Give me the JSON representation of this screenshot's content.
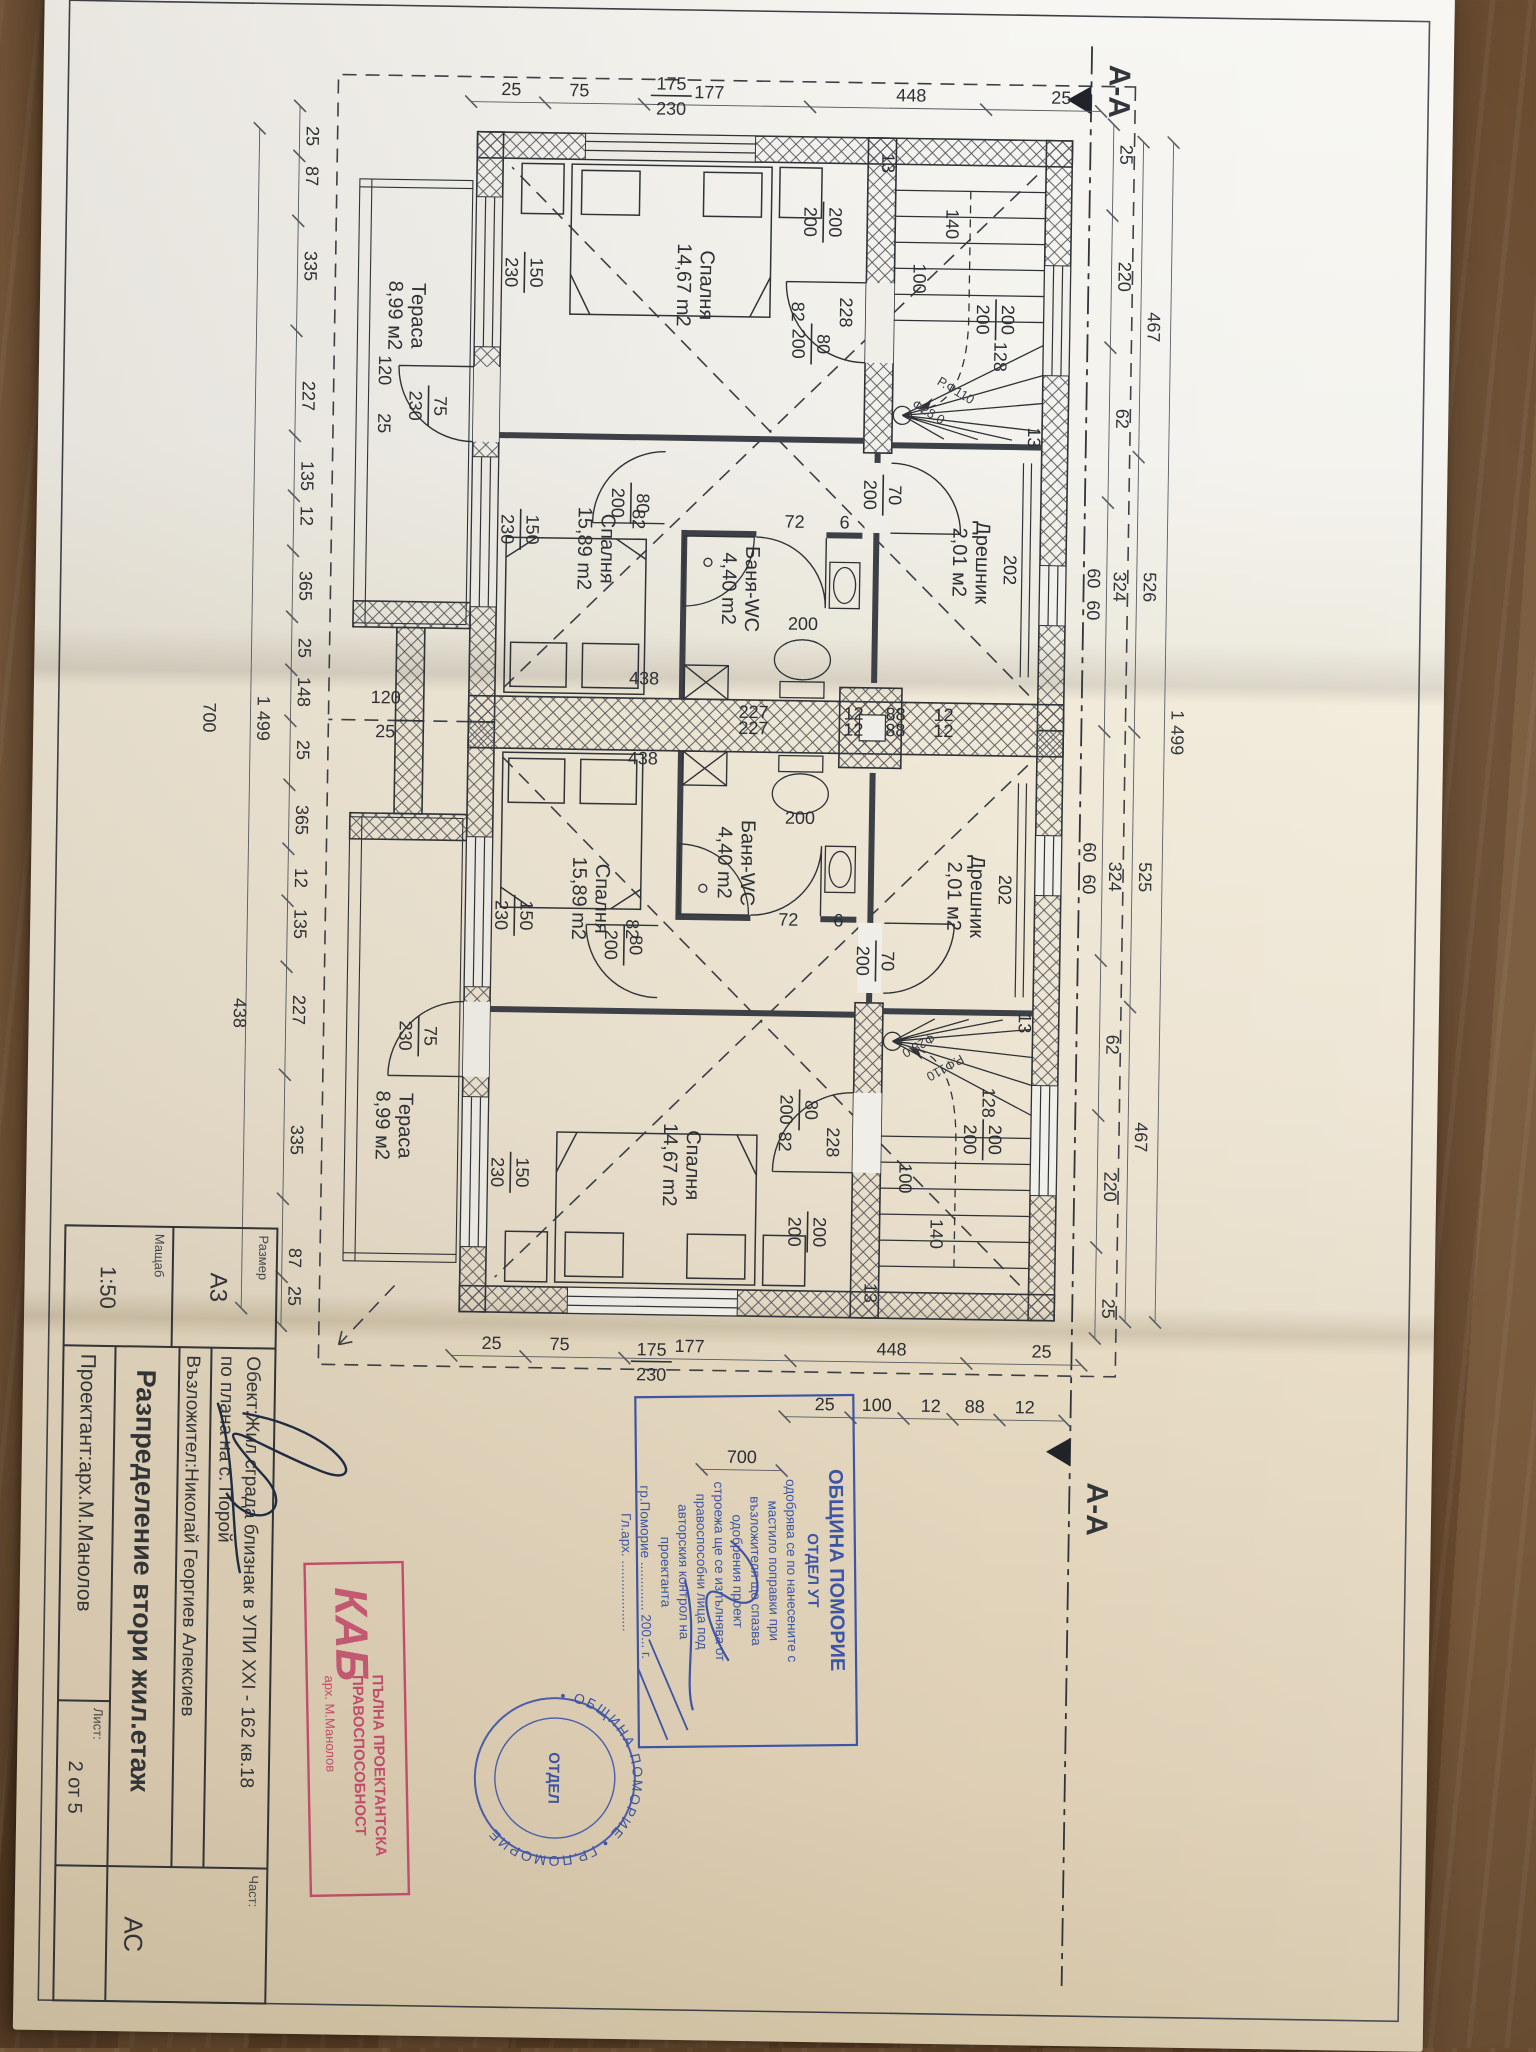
{
  "title_block": {
    "size_label": "Размер",
    "size": "А3",
    "scale_label": "Мащаб",
    "scale": "1:50",
    "object_line1": "Обект:Жил.сграда близнак в УПИ XXI - 162 кв.18",
    "object_line2": "по плана на с. Порой",
    "client": "Възложител:Николай Георгиев Алексиев",
    "drawing_title": "Разпределение втори жил.етаж",
    "designer": "Проектант:арх.М.Манолов",
    "sheet_label": "Лист:",
    "sheet": "2 от 5",
    "part_label": "Част:",
    "part": "АС"
  },
  "section": {
    "label": "А-А"
  },
  "stamps": {
    "municipality": {
      "lines": [
        "ОБЩИНА ПОМОРИЕ",
        "ОТДЕЛ УТ",
        "одобрява се по нанесените с",
        "мастило поправки при",
        "възложителя ще спазва",
        "одобрения проект",
        "строежа ще се изпълнява от",
        "правоспособни лица под",
        "авторския контрол на",
        "проектанта",
        "гр.Поморие ............. 200... г.",
        "Гл.арх. ..................."
      ]
    },
    "seal": {
      "rim": "• ОБЩИНА ПОМОРИЕ • ГР.ПОМОРИЕ",
      "center": "ОТДЕЛ"
    },
    "license": {
      "logo": "КАБ",
      "line1": "ПЪЛНА ПРОЕКТАНТСКА",
      "line2": "ПРАВОСПОСОБНОСТ",
      "name": "арх. М.Манолов"
    }
  },
  "plan": {
    "rooms": [
      {
        "lines": [
          "Спалня",
          "14,67 m2"
        ],
        "x": 305,
        "y": 750
      },
      {
        "lines": [
          "Спалня",
          "15,89 m2"
        ],
        "x": 570,
        "y": 845
      },
      {
        "lines": [
          "Баня-WC",
          "4,40 m2"
        ],
        "x": 608,
        "y": 700
      },
      {
        "lines": [
          "Дрешник",
          "2,01 м2"
        ],
        "x": 578,
        "y": 470
      },
      {
        "lines": [
          "Тераса",
          "8,99 м2"
        ],
        "x": 340,
        "y": 1038
      },
      {
        "lines": [
          "Спалня",
          "14,67 m2"
        ],
        "x": 1185,
        "y": 750
      },
      {
        "lines": [
          "Спалня",
          "15,89 m2"
        ],
        "x": 920,
        "y": 845
      },
      {
        "lines": [
          "Баня-WC",
          "4,40 m2"
        ],
        "x": 882,
        "y": 700
      },
      {
        "lines": [
          "Дрешник",
          "2,01 м2"
        ],
        "x": 912,
        "y": 470
      },
      {
        "lines": [
          "Тераса",
          "8,99 м2"
        ],
        "x": 1150,
        "y": 1038
      }
    ],
    "tags": [
      {
        "a": "175",
        "b": "230",
        "x": 112,
        "y": 782,
        "r": -90
      },
      {
        "a": "200",
        "b": "200",
        "x": 335,
        "y": 450
      },
      {
        "a": "200",
        "b": "200",
        "x": 240,
        "y": 624
      },
      {
        "a": "150",
        "b": "230",
        "x": 295,
        "y": 922
      },
      {
        "a": "150",
        "b": "230",
        "x": 552,
        "y": 922
      },
      {
        "a": "75",
        "b": "230",
        "x": 430,
        "y": 1016
      },
      {
        "a": "80",
        "b": "200",
        "x": 362,
        "y": 634
      },
      {
        "a": "80",
        "b": "200",
        "x": 524,
        "y": 812
      },
      {
        "a": "70",
        "b": "200",
        "x": 512,
        "y": 560
      },
      {
        "a": "175",
        "b": "230",
        "x": 1378,
        "y": 782,
        "r": -90
      },
      {
        "a": "200",
        "b": "200",
        "x": 1155,
        "y": 450
      },
      {
        "a": "200",
        "b": "200",
        "x": 1250,
        "y": 624
      },
      {
        "a": "150",
        "b": "230",
        "x": 1195,
        "y": 922
      },
      {
        "a": "150",
        "b": "230",
        "x": 938,
        "y": 922
      },
      {
        "a": "75",
        "b": "230",
        "x": 1060,
        "y": 1016
      },
      {
        "a": "80",
        "b": "200",
        "x": 1128,
        "y": 634
      },
      {
        "a": "80",
        "b": "200",
        "x": 966,
        "y": 812
      },
      {
        "a": "70",
        "b": "200",
        "x": 978,
        "y": 560
      }
    ],
    "dims": [
      {
        "t": "25",
        "x": 168,
        "y": 332
      },
      {
        "t": "220",
        "x": 290,
        "y": 332
      },
      {
        "t": "62",
        "x": 432,
        "y": 332
      },
      {
        "t": "324",
        "x": 600,
        "y": 332
      },
      {
        "t": "324",
        "x": 890,
        "y": 332
      },
      {
        "t": "62",
        "x": 1058,
        "y": 332
      },
      {
        "t": "220",
        "x": 1200,
        "y": 332
      },
      {
        "t": "25",
        "x": 1322,
        "y": 332
      },
      {
        "t": "467",
        "x": 340,
        "y": 302
      },
      {
        "t": "526",
        "x": 600,
        "y": 302
      },
      {
        "t": "525",
        "x": 890,
        "y": 302
      },
      {
        "t": "467",
        "x": 1150,
        "y": 302
      },
      {
        "t": "1 499",
        "x": 745,
        "y": 272
      },
      {
        "t": "25",
        "x": 162,
        "y": 1146
      },
      {
        "t": "87",
        "x": 202,
        "y": 1146
      },
      {
        "t": "335",
        "x": 292,
        "y": 1146
      },
      {
        "t": "227",
        "x": 422,
        "y": 1146
      },
      {
        "t": "135",
        "x": 502,
        "y": 1146
      },
      {
        "t": "12",
        "x": 542,
        "y": 1146
      },
      {
        "t": "365",
        "x": 612,
        "y": 1146
      },
      {
        "t": "25",
        "x": 674,
        "y": 1146
      },
      {
        "t": "148",
        "x": 718,
        "y": 1146
      },
      {
        "t": "25",
        "x": 776,
        "y": 1146
      },
      {
        "t": "365",
        "x": 846,
        "y": 1146
      },
      {
        "t": "12",
        "x": 904,
        "y": 1146
      },
      {
        "t": "135",
        "x": 950,
        "y": 1146
      },
      {
        "t": "227",
        "x": 1036,
        "y": 1146
      },
      {
        "t": "335",
        "x": 1166,
        "y": 1146
      },
      {
        "t": "87",
        "x": 1284,
        "y": 1146
      },
      {
        "t": "25",
        "x": 1322,
        "y": 1146
      },
      {
        "t": "1 499",
        "x": 745,
        "y": 1186
      },
      {
        "t": "25",
        "x": 118,
        "y": 392,
        "r": -90
      },
      {
        "t": "448",
        "x": 118,
        "y": 542,
        "r": -90
      },
      {
        "t": "177",
        "x": 118,
        "y": 744,
        "r": -90
      },
      {
        "t": "75",
        "x": 118,
        "y": 874,
        "r": -90
      },
      {
        "t": "25",
        "x": 118,
        "y": 942,
        "r": -90
      },
      {
        "t": "25",
        "x": 1372,
        "y": 392,
        "r": -90
      },
      {
        "t": "448",
        "x": 1372,
        "y": 542,
        "r": -90
      },
      {
        "t": "177",
        "x": 1372,
        "y": 744,
        "r": -90
      },
      {
        "t": "75",
        "x": 1372,
        "y": 874,
        "r": -90
      },
      {
        "t": "25",
        "x": 1372,
        "y": 942,
        "r": -90
      },
      {
        "t": "12",
        "x": 1428,
        "y": 408,
        "r": -90
      },
      {
        "t": "88",
        "x": 1428,
        "y": 458,
        "r": -90
      },
      {
        "t": "12",
        "x": 1428,
        "y": 502,
        "r": -90
      },
      {
        "t": "100",
        "x": 1428,
        "y": 556,
        "r": -90
      },
      {
        "t": "25",
        "x": 1428,
        "y": 608,
        "r": -90
      },
      {
        "t": "700",
        "x": 1482,
        "y": 690,
        "r": -90
      },
      {
        "t": "438",
        "x": 1040,
        "y": 1205
      },
      {
        "t": "700",
        "x": 745,
        "y": 1240
      },
      {
        "t": "202",
        "x": 585,
        "y": 442
      },
      {
        "t": "228",
        "x": 330,
        "y": 610
      },
      {
        "t": "140",
        "x": 240,
        "y": 505
      },
      {
        "t": "100",
        "x": 295,
        "y": 537
      },
      {
        "t": "128",
        "x": 372,
        "y": 455
      },
      {
        "t": "13",
        "x": 452,
        "y": 420
      },
      {
        "t": "13",
        "x": 180,
        "y": 570
      },
      {
        "t": "12",
        "x": 737,
        "y": 500,
        "r": -90
      },
      {
        "t": "88",
        "x": 737,
        "y": 548,
        "r": -90
      },
      {
        "t": "12",
        "x": 737,
        "y": 590,
        "r": -90
      },
      {
        "t": "227",
        "x": 737,
        "y": 690,
        "r": -90
      },
      {
        "t": "12",
        "x": 753,
        "y": 500,
        "r": -90
      },
      {
        "t": "88",
        "x": 753,
        "y": 548,
        "r": -90
      },
      {
        "t": "12",
        "x": 753,
        "y": 590,
        "r": -90
      },
      {
        "t": "227",
        "x": 753,
        "y": 690,
        "r": -90
      },
      {
        "t": "438",
        "x": 705,
        "y": 800,
        "r": -90
      },
      {
        "t": "438",
        "x": 785,
        "y": 800,
        "r": -90
      },
      {
        "t": "200",
        "x": 648,
        "y": 642,
        "r": -90
      },
      {
        "t": "200",
        "x": 842,
        "y": 642,
        "r": -90
      },
      {
        "t": "6",
        "x": 546,
        "y": 602,
        "r": -90
      },
      {
        "t": "72",
        "x": 546,
        "y": 652,
        "r": -90
      },
      {
        "t": "6",
        "x": 944,
        "y": 602,
        "r": -90
      },
      {
        "t": "72",
        "x": 944,
        "y": 652,
        "r": -90
      },
      {
        "t": "82",
        "x": 330,
        "y": 658
      },
      {
        "t": "82",
        "x": 540,
        "y": 814
      },
      {
        "t": "82",
        "x": 1160,
        "y": 658
      },
      {
        "t": "82",
        "x": 950,
        "y": 814
      },
      {
        "t": "60",
        "x": 592,
        "y": 358
      },
      {
        "t": "60",
        "x": 624,
        "y": 358
      },
      {
        "t": "60",
        "x": 866,
        "y": 358
      },
      {
        "t": "60",
        "x": 898,
        "y": 358
      },
      {
        "t": "120",
        "x": 728,
        "y": 1058,
        "r": -90
      },
      {
        "t": "25",
        "x": 762,
        "y": 1058,
        "r": -90
      },
      {
        "t": "202",
        "x": 905,
        "y": 442
      },
      {
        "t": "228",
        "x": 1160,
        "y": 610
      },
      {
        "t": "140",
        "x": 1250,
        "y": 505
      },
      {
        "t": "100",
        "x": 1195,
        "y": 537
      },
      {
        "t": "128",
        "x": 1118,
        "y": 455
      },
      {
        "t": "13",
        "x": 1038,
        "y": 420
      },
      {
        "t": "13",
        "x": 1310,
        "y": 570
      },
      {
        "t": "120",
        "x": 395,
        "y": 1070
      },
      {
        "t": "25",
        "x": 448,
        "y": 1070
      }
    ],
    "notes": [
      {
        "t": "Р.Ф110",
        "x": 410,
        "y": 495,
        "r": -60
      },
      {
        "t": "Ф28.0",
        "x": 432,
        "y": 522,
        "r": -60
      },
      {
        "t": "Р.Ф110",
        "x": 1080,
        "y": 495,
        "r": 60
      },
      {
        "t": "Ф28.0",
        "x": 1058,
        "y": 522,
        "r": 60
      }
    ]
  }
}
